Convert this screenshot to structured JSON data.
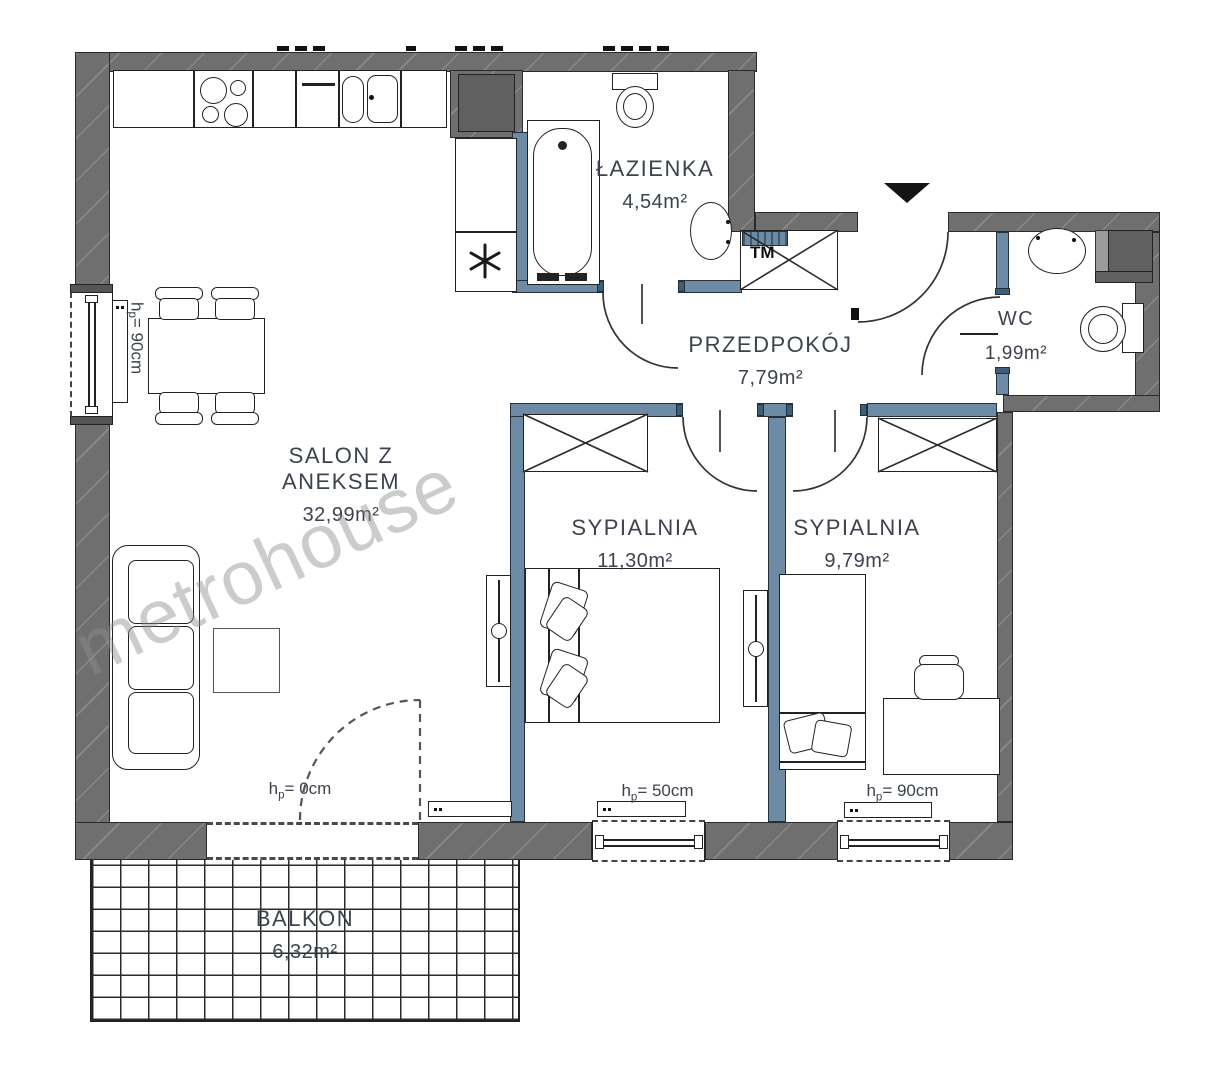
{
  "watermark": "metrohouse",
  "rooms": {
    "bathroom": {
      "name": "ŁAZIENKA",
      "area": "4,54m²"
    },
    "hallway": {
      "name": "PRZEDPOKÓJ",
      "area": "7,79m²"
    },
    "wc": {
      "name": "WC",
      "area": "1,99m²"
    },
    "living": {
      "name": "SALON Z ANEKSEM",
      "area": "32,99m²"
    },
    "bedroom1": {
      "name": "SYPIALNIA",
      "area": "11,30m²"
    },
    "bedroom2": {
      "name": "SYPIALNIA",
      "area": "9,79m²"
    },
    "balcony": {
      "name": "BALKON",
      "area": "6,32m²"
    }
  },
  "dimensions": {
    "window_living": {
      "pre": "h",
      "sub": "p",
      "post": "= 90cm"
    },
    "balcony_door": {
      "pre": "h",
      "sub": "p",
      "post": "= 0cm"
    },
    "window_bedroom1": {
      "pre": "h",
      "sub": "p",
      "post": "= 50cm"
    },
    "window_bedroom2": {
      "pre": "h",
      "sub": "p",
      "post": "= 90cm"
    }
  },
  "annotations": {
    "tm_unit": "TM"
  },
  "colors": {
    "wall": "#6f6f6f",
    "partition": "#6d8ba4",
    "line": "#222222",
    "text": "#3d434e",
    "watermark": "#8f8f8f"
  }
}
